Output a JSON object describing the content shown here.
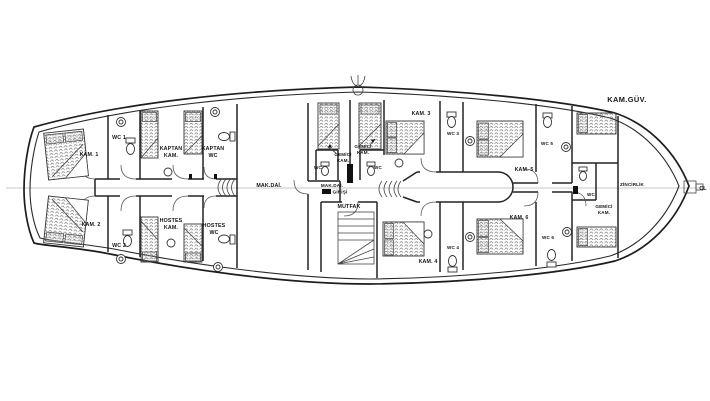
{
  "colors": {
    "ink": "#1d1d1d",
    "centerline": "#b5b5b5",
    "paper": "#ffffff"
  },
  "plan": {
    "stern_cabins": {
      "kam1": "KAM. 1",
      "wc1": "WC 1",
      "kam2": "KAM. 2",
      "wc2": "WC 2"
    },
    "crew_aft": {
      "kaptan_kam": [
        "KAPTAN",
        "KAM."
      ],
      "kaptan_wc": [
        "KAPTAN",
        "WC"
      ],
      "hostes_kam": [
        "HOSTES",
        "KAM."
      ],
      "hostes_wc": [
        "HOSTES",
        "WC"
      ]
    },
    "engine": {
      "mak_dai": "MAK.DAİ.",
      "mak_dai_giris": [
        "MAK.DAİ.",
        "GİRİŞİ"
      ]
    },
    "galley": {
      "mutfak": "MUTFAK"
    },
    "crew_mid": {
      "gemici_kam_port": [
        "GEMİCİ",
        "KAM."
      ],
      "gemici_kam_starboard": [
        "GEMİCİ",
        "KAM."
      ],
      "wc_port": "WC",
      "wc_starboard": "WC"
    },
    "guest_cabins": {
      "kam3": "KAM. 3",
      "wc3": "WC 3",
      "kam4": "KAM. 4",
      "wc4": "WC 4",
      "kam5": "KAM. 5",
      "wc5": "WC 5",
      "kam6": "KAM. 6",
      "wc6": "WC 6"
    },
    "crew_bow": {
      "wc": "WC",
      "gemici_kam": [
        "GEMİCİ",
        "KAM."
      ]
    },
    "bow": {
      "zincirlik": "ZİNCİRLİK",
      "cl": "CL",
      "kam_guv": "KAM.GÜV."
    }
  }
}
